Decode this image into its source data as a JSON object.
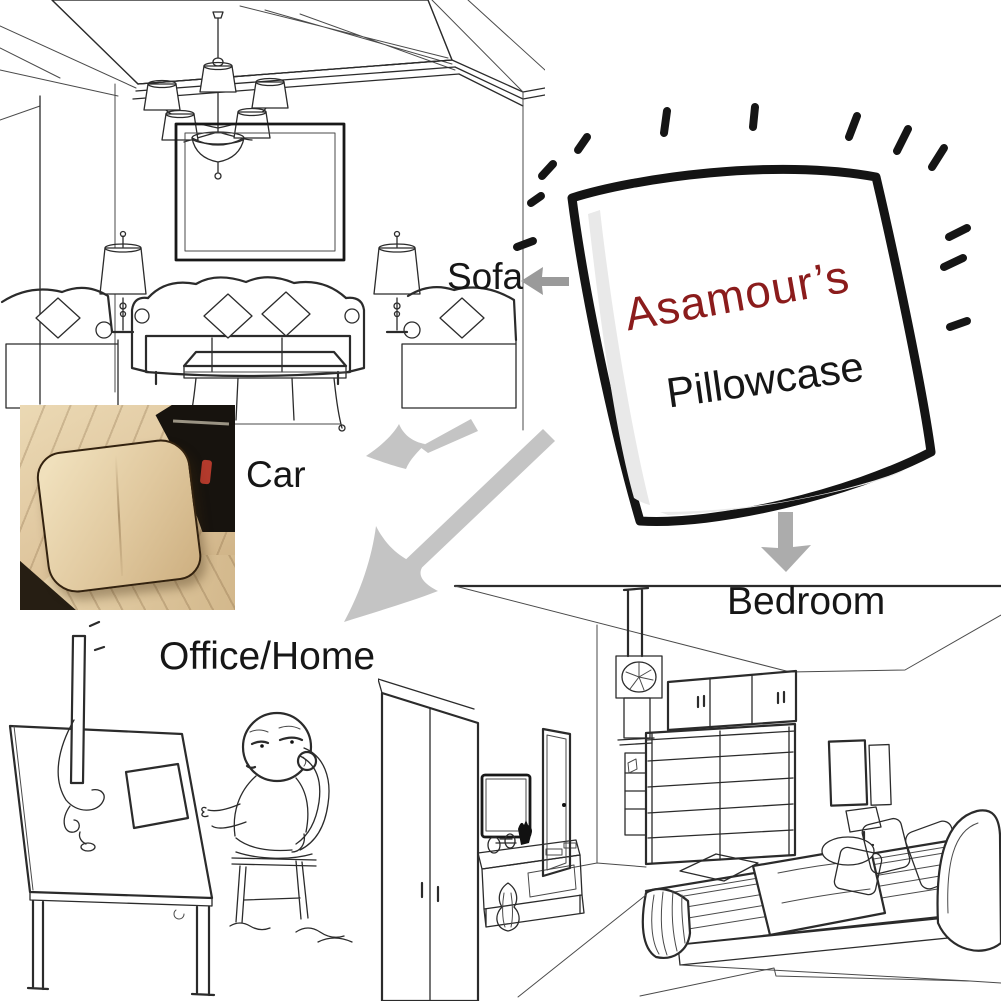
{
  "brand": {
    "name": "Asamour’s",
    "product": "Pillowcase"
  },
  "scenes": {
    "sofa": {
      "label": "Sofa"
    },
    "car": {
      "label": "Car"
    },
    "office": {
      "label": "Office/Home"
    },
    "bedroom": {
      "label": "Bedroom"
    }
  },
  "colors": {
    "brand_red": "#8B1C1C",
    "label_black": "#161616",
    "line_art": "#2B2B2B",
    "pillow_outline": "#141414",
    "arrow_small": "#9A9A9A",
    "arrow_large": "#C4C4C4",
    "arrow_down": "#ACACAC",
    "car_seat_beige": "#DFC69E",
    "car_pillow_beige": "#E0C89E",
    "car_piping_brown": "#33220F",
    "car_console_black": "#17130E",
    "car_buckle_red": "#B33A2C"
  }
}
